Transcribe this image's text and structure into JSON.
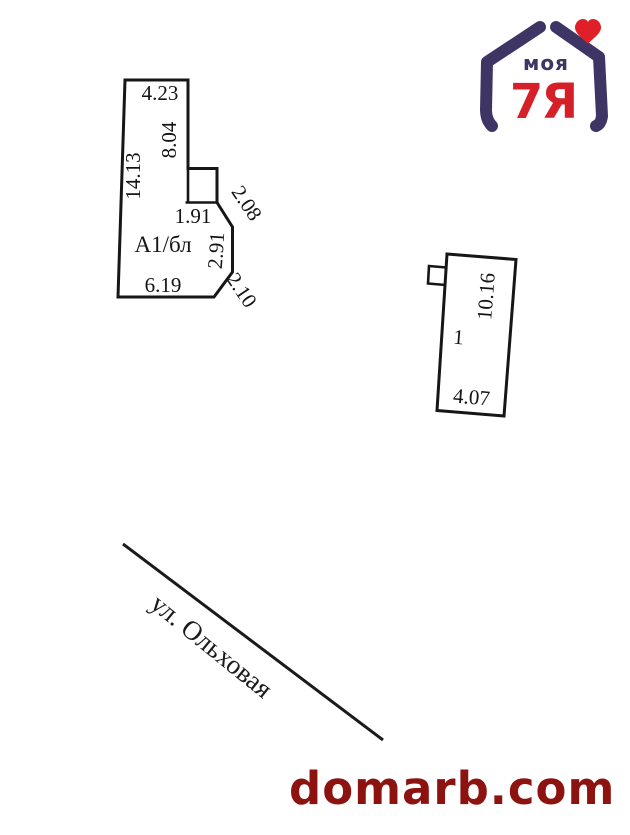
{
  "page": {
    "background": "#ffffff"
  },
  "logo": {
    "text_top": "моя",
    "text_bottom": "7Я",
    "navy": "#3E3565",
    "red": "#D62028",
    "heart_red": "#E02028"
  },
  "plan": {
    "building_left": {
      "label": "А1/бл",
      "dim_top": "4.23",
      "dim_right_upper": "8.04",
      "dim_left": "14.13",
      "dim_annex_bottom": "1.91",
      "dim_diag_upper": "2.08",
      "dim_right_lower": "2.91",
      "dim_bottom": "6.19",
      "dim_diag_lower": "2.10"
    },
    "building_right": {
      "label": "1",
      "dim_right": "10.16",
      "dim_bottom": "4.07"
    },
    "street": {
      "name": "ул. Ольховая"
    },
    "line_color": "#161616"
  },
  "watermark": {
    "text": "domarb.com",
    "color": "#8C1310"
  }
}
